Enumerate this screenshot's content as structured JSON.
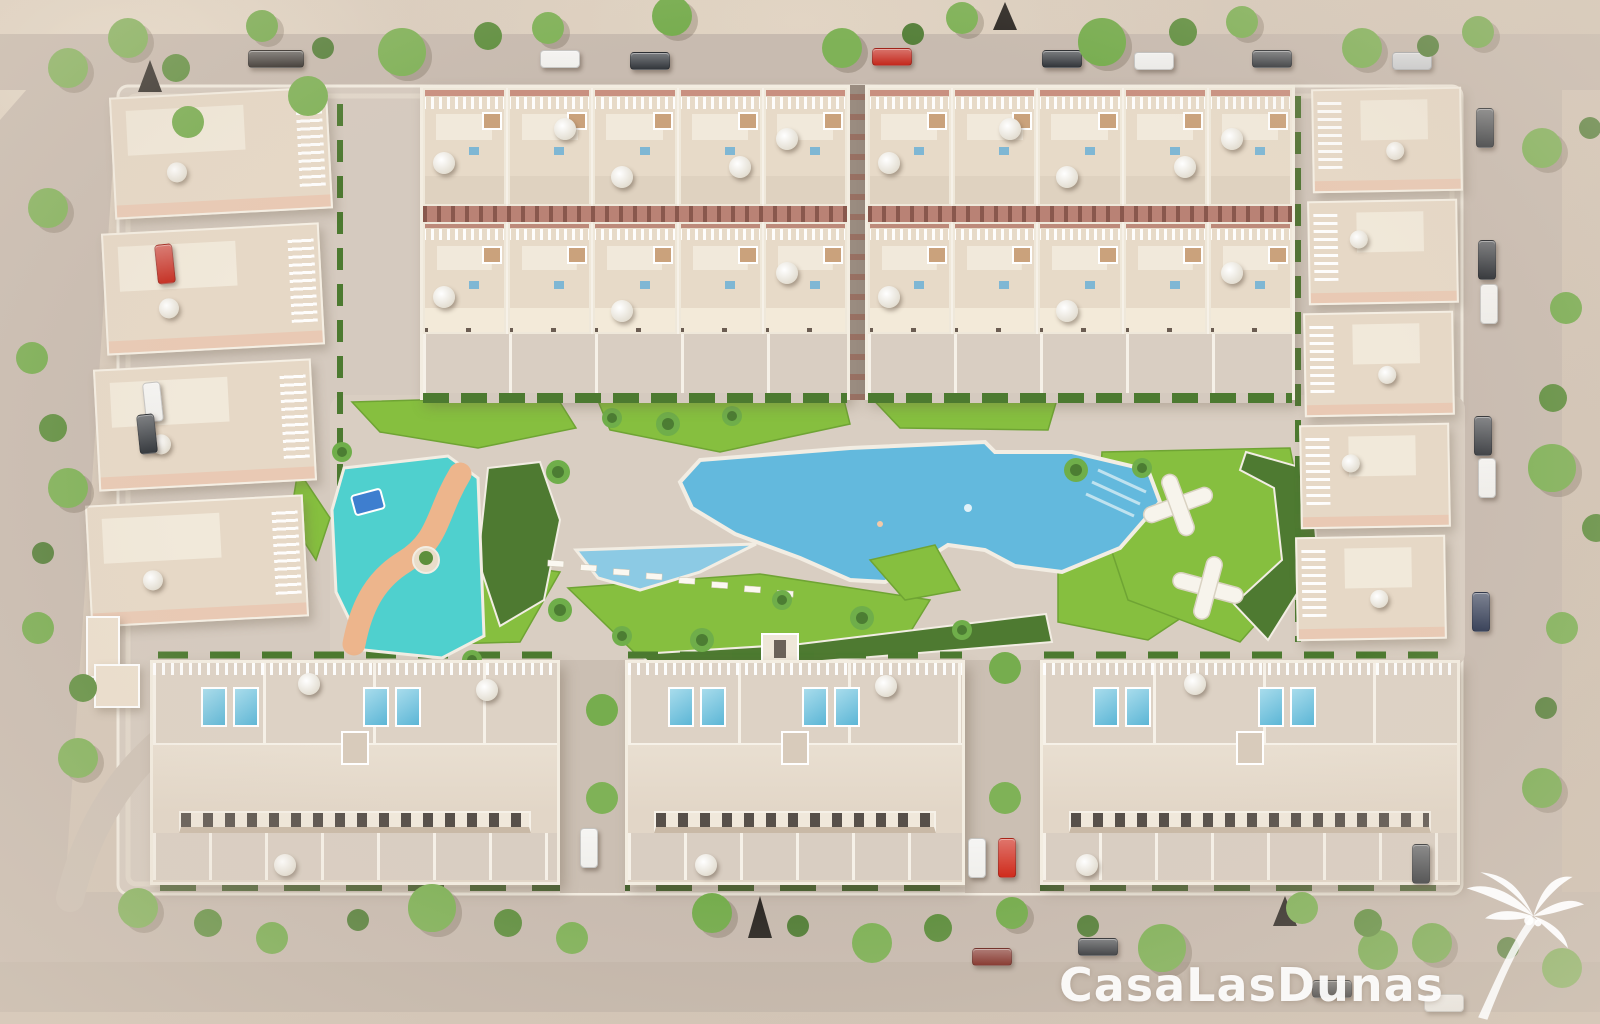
{
  "watermark": {
    "text": "CasaLasDunas",
    "icon": "palm-tree-icon"
  },
  "scene": {
    "kind": "aerial-3d-render",
    "subject": "residential development masterplan render with central pool park",
    "areas": {
      "north_housing": "two townhouse blocks, two rows of five units each, rooftop terraces with parasols",
      "west_housing": "four angled house clusters with white pergolas",
      "east_housing": "five house clusters with white pergolas",
      "south_housing": "three long blocks with rooftop solariums, plunge pools and window strips",
      "main_pool": "large irregular lagoon swimming pool with steps and sun loungers",
      "secondary_pool": "small triangular pool",
      "kids_pool": "turquoise splash pool with orange winding slide path, water slide and palm island",
      "playground": "lawn with white climbing structures and curved planting bed",
      "streets": "perimeter roads with parked cars and street trees"
    }
  },
  "colors": {
    "grass": "#86bf3f",
    "grass_dark": "#6fa434",
    "bed": "#4e7a31",
    "hedge": "#4c7a30",
    "pool": "#63b9dd",
    "pool_light": "#8ccae4",
    "kids_pool": "#4fd0ce",
    "slide_path": "#edb58c",
    "minipool": "#5cb6d6",
    "lane": "#b98275",
    "pink": "#e9c9b4",
    "window": "#57504a",
    "car_red": "#c4291d",
    "car_white": "#f0efec",
    "car_dark": "#33373c",
    "watermark": "rgba(255,255,255,0.92)"
  }
}
